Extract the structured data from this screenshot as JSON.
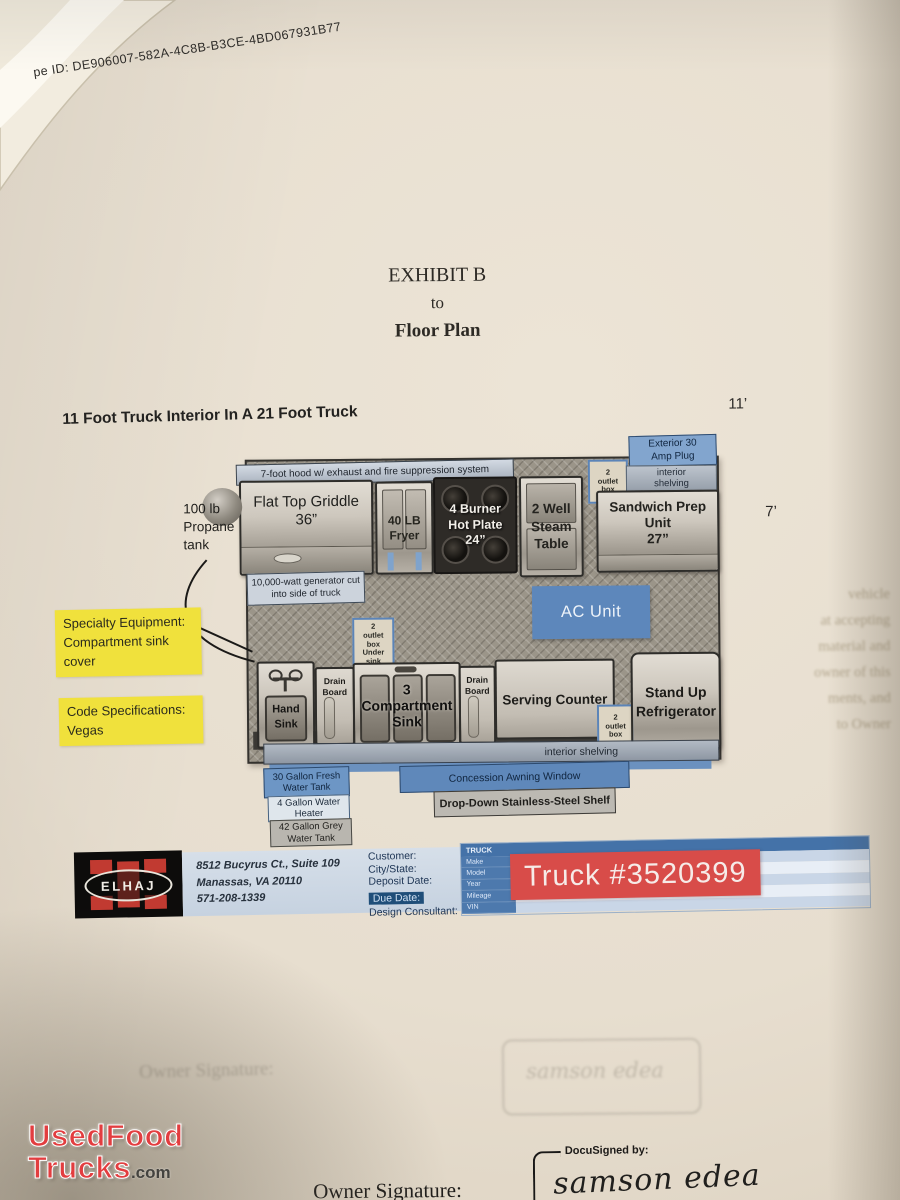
{
  "doc": {
    "envelope_id": "pe ID: DE906007-582A-4C8B-B3CE-4BD067931B77",
    "title": {
      "line1": "EXHIBIT B",
      "line2": "to",
      "line3": "Floor Plan"
    },
    "heading": "11 Foot Truck Interior In A 21 Foot Truck",
    "dims": {
      "width": "11’",
      "depth": "7’"
    }
  },
  "plan": {
    "hood": "7-foot hood w/ exhaust and fire suppression system",
    "griddle": "Flat Top Griddle\n36”",
    "fryer": "40 LB\nFryer",
    "hotplate": "4 Burner\nHot Plate\n24”",
    "steam_table": "2 Well\nSteam\nTable",
    "outlet_top": "2\noutlet\nbox",
    "exterior_plug": "Exterior 30\nAmp Plug",
    "shelving_top": "interior\nshelving",
    "sandwich_prep": "Sandwich Prep\nUnit\n27”",
    "ac_unit": "AC Unit",
    "outlet_under_sink": "2\noutlet\nbox\nUnder\nsink",
    "hand_sink": "Hand\nSink",
    "drain_board": "Drain\nBoard",
    "comp_sink": "3\nCompartment\nSink",
    "serving_counter": "Serving Counter",
    "outlet_counter": "2\noutlet\nbox",
    "refrigerator": "Stand Up\nRefrigerator",
    "shelving_bottom": "interior shelving",
    "generator": "10,000-watt generator cut\ninto side of truck",
    "propane": "100 lb\nPropane\ntank",
    "fresh_tank": "30 Gallon Fresh\nWater Tank",
    "water_heater": "4 Gallon Water\nHeater",
    "grey_tank": "42 Gallon Grey\nWater Tank",
    "awning": "Concession Awning Window",
    "drop_shelf": "Drop-Down Stainless-Steel Shelf"
  },
  "notes": {
    "specialty": "Specialty Equipment:\nCompartment sink\ncover",
    "code": "Code Specifications:\nVegas"
  },
  "footer": {
    "logo_text": "ELHAJ",
    "address": "8512 Bucyrus Ct., Suite 109\nManassas, VA 20110\n571-208-1339",
    "fields": [
      "Customer:",
      "City/State:",
      "Deposit Date:",
      "Due Date:",
      "Design Consultant:"
    ],
    "table": {
      "header": "TRUCK",
      "rows": [
        "Make",
        "Model",
        "Year",
        "Mileage",
        "VIN"
      ]
    },
    "truck_number": "Truck #3520399"
  },
  "signature": {
    "label": "Owner Signature:",
    "docusign": "DocuSigned by:",
    "name": "samson edea"
  },
  "watermark": {
    "line1": "UsedFood",
    "line2": "Trucks",
    "suffix": ".com"
  },
  "bleed": {
    "lines": [
      "vehicle",
      "at accepting",
      "material and",
      "owner of this",
      "ments, and",
      "to Owner"
    ]
  },
  "colors": {
    "highlight_yellow": "#f0e13c",
    "plan_blue": "#5d87bb",
    "truck_red": "#d84c49",
    "table_blue": "#4472a8",
    "logo_red": "#c13a31",
    "watermark_red": "#e23d3f"
  }
}
